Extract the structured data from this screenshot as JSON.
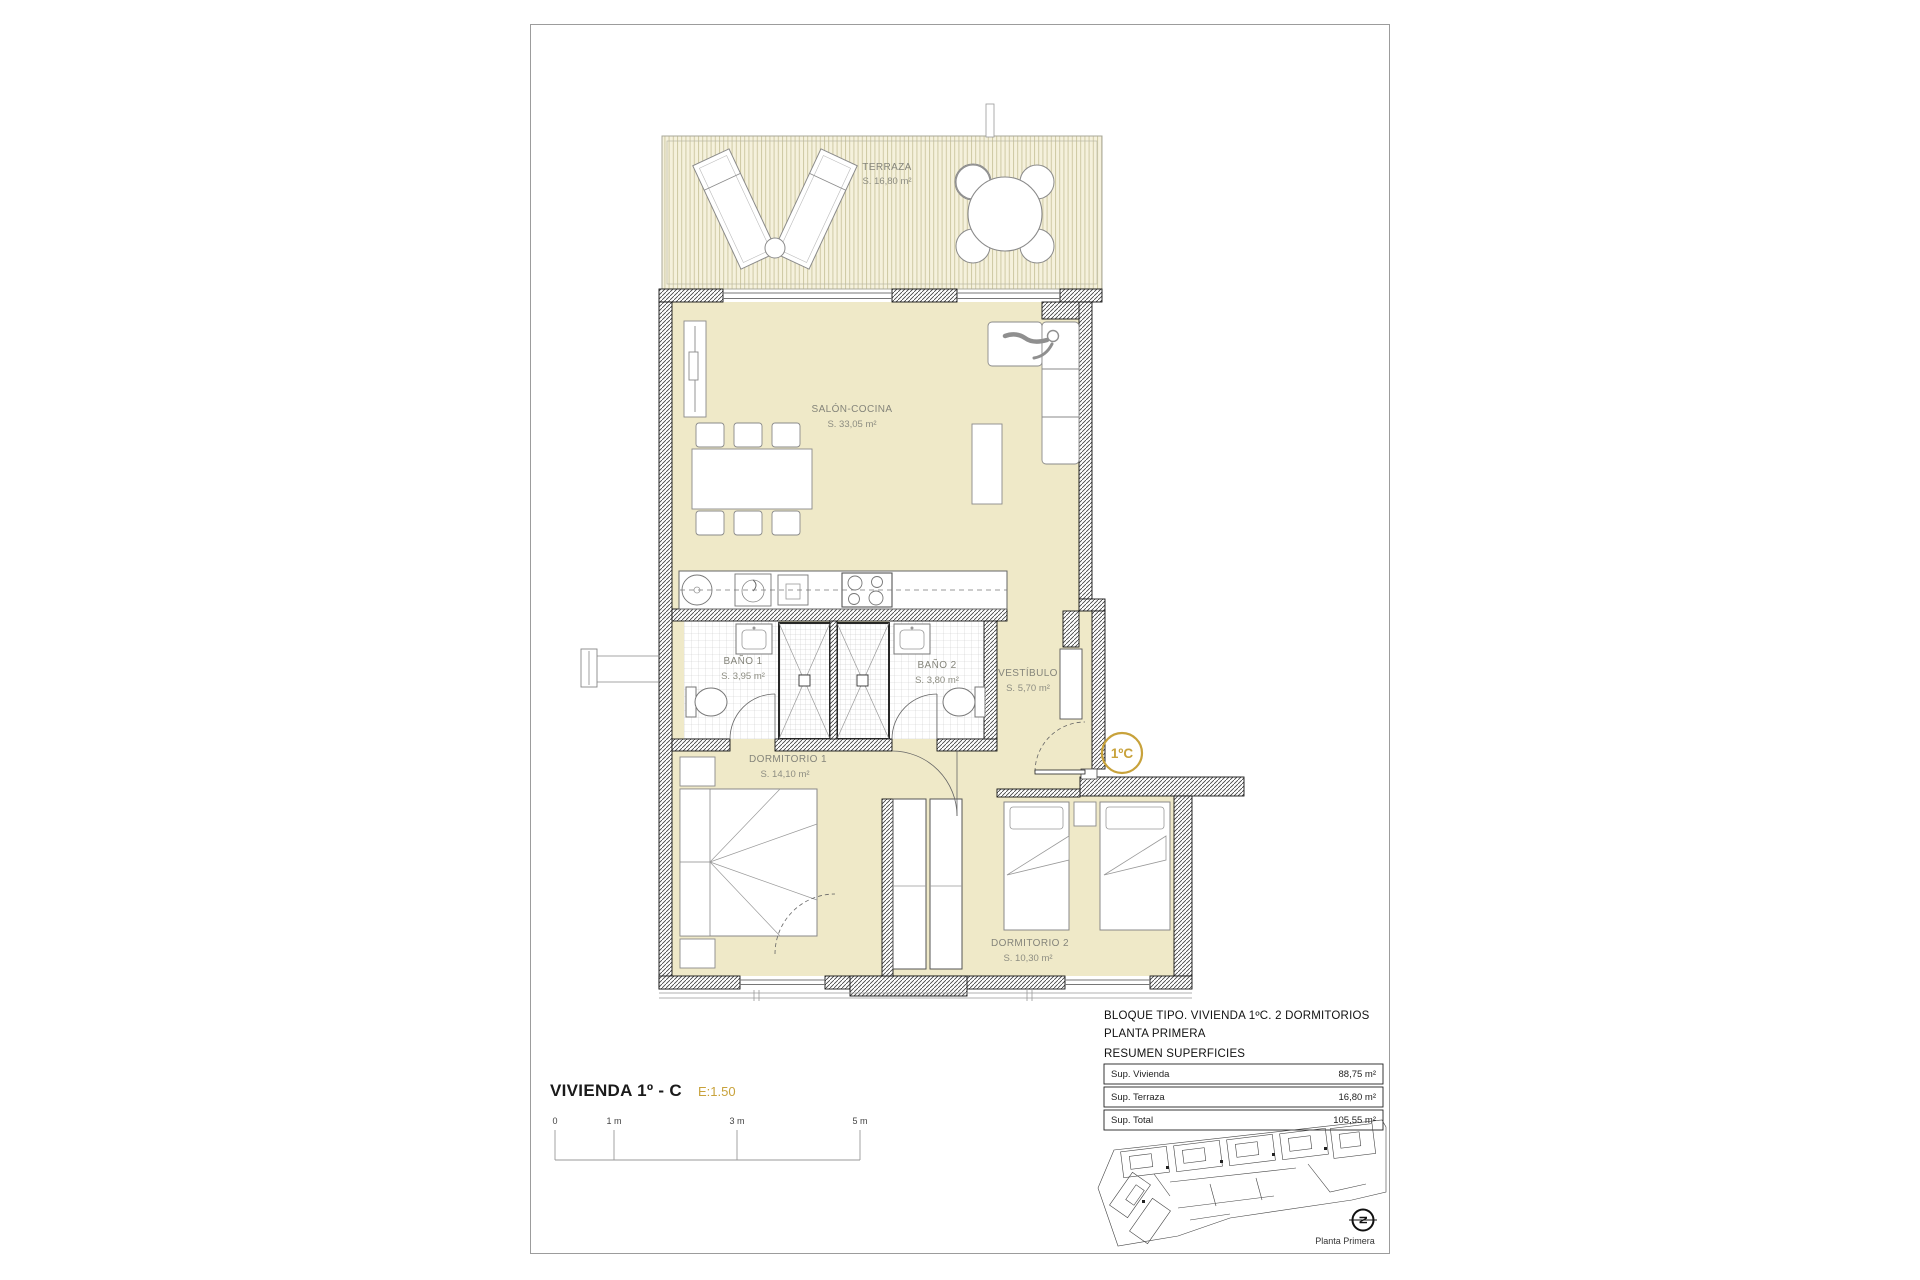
{
  "title": {
    "main": "VIVIENDA 1º - C",
    "scale": "E:1.50"
  },
  "rooms": {
    "terraza": {
      "name": "TERRAZA",
      "area": "S. 16,80 m²"
    },
    "salon": {
      "name": "SALÓN-COCINA",
      "area": "S. 33,05 m²"
    },
    "bano1": {
      "name": "BAÑO 1",
      "area": "S. 3,95 m²"
    },
    "bano2": {
      "name": "BAÑO 2",
      "area": "S. 3,80 m²"
    },
    "vestibulo": {
      "name": "VESTÍBULO",
      "area": "S. 5,70 m²"
    },
    "dormitorio1": {
      "name": "DORMITORIO 1",
      "area": "S. 14,10 m²"
    },
    "dormitorio2": {
      "name": "DORMITORIO 2",
      "area": "S. 10,30 m²"
    }
  },
  "badge": {
    "label": "1ºC"
  },
  "scale_bar": {
    "t0": "0",
    "t1": "1 m",
    "t2": "3 m",
    "t3": "5 m"
  },
  "title_block": {
    "line1": "BLOQUE TIPO. VIVIENDA 1ºC. 2 DORMITORIOS",
    "line2": "PLANTA PRIMERA",
    "line3": "RESUMEN SUPERFICIES",
    "rows": [
      {
        "label": "Sup. Vivienda",
        "value": "88,75 m²"
      },
      {
        "label": "Sup. Terraza",
        "value": "16,80 m²"
      },
      {
        "label": "Sup. Total",
        "value": "105,55 m²"
      }
    ],
    "caption": "Planta Primera",
    "north_letter": "N"
  },
  "colors": {
    "accent_gold": "#c8a23b",
    "floor_cream": "#efe9c8",
    "terrace_base": "#f5f1dc",
    "terrace_stripe": "#cfc9a4",
    "wall_ink": "#1a1a1a"
  }
}
